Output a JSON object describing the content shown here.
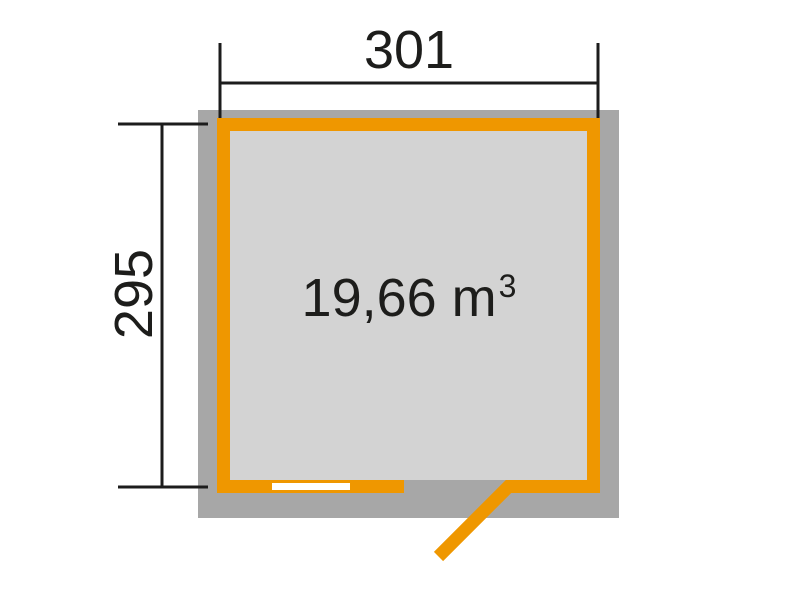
{
  "figure": {
    "type": "floor-plan-top-view",
    "dimensions": {
      "width": {
        "label": "301"
      },
      "height": {
        "label": "295"
      }
    },
    "volume": {
      "text": "19,66 m",
      "exponent": "3"
    },
    "colors": {
      "wall": "#ef9700",
      "roof_footprint": "#a7a7a7",
      "floor": "#d3d3d3",
      "window": "#ffffff",
      "dimension_line": "#1c1c1c",
      "background": "#ffffff"
    }
  }
}
